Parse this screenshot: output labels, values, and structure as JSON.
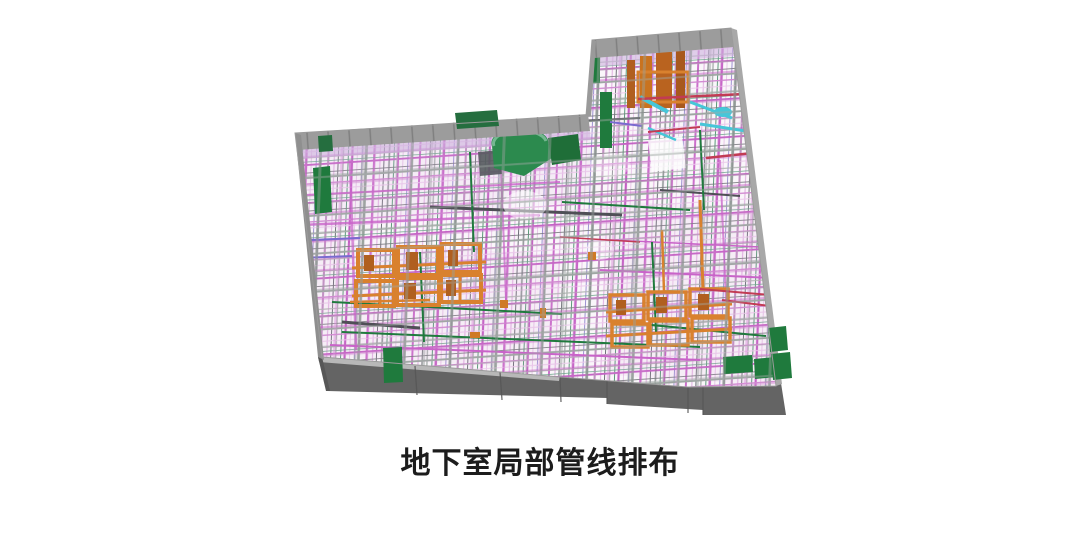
{
  "figure": {
    "caption": "地下室局部管线排布"
  },
  "palette": {
    "background": "#ffffff",
    "caption_color": "#1c1c1c",
    "slab_gray": "#9c9c9c",
    "slab_edge_gray": "#8f8f8f",
    "base_dark_gray": "#646464",
    "beam_gray": "#9aa39f",
    "pipe_magenta": "#c963c9",
    "pipe_magenta_light": "#e6bde6",
    "duct_orange": "#d9812e",
    "duct_orange_dark": "#b05f1f",
    "equipment_green": "#1f7a3d",
    "equipment_green_bright": "#2c8a4e",
    "pipe_cyan": "#46c6d8",
    "pipe_red": "#c23b54",
    "pipe_purple": "#7a6ad0"
  }
}
